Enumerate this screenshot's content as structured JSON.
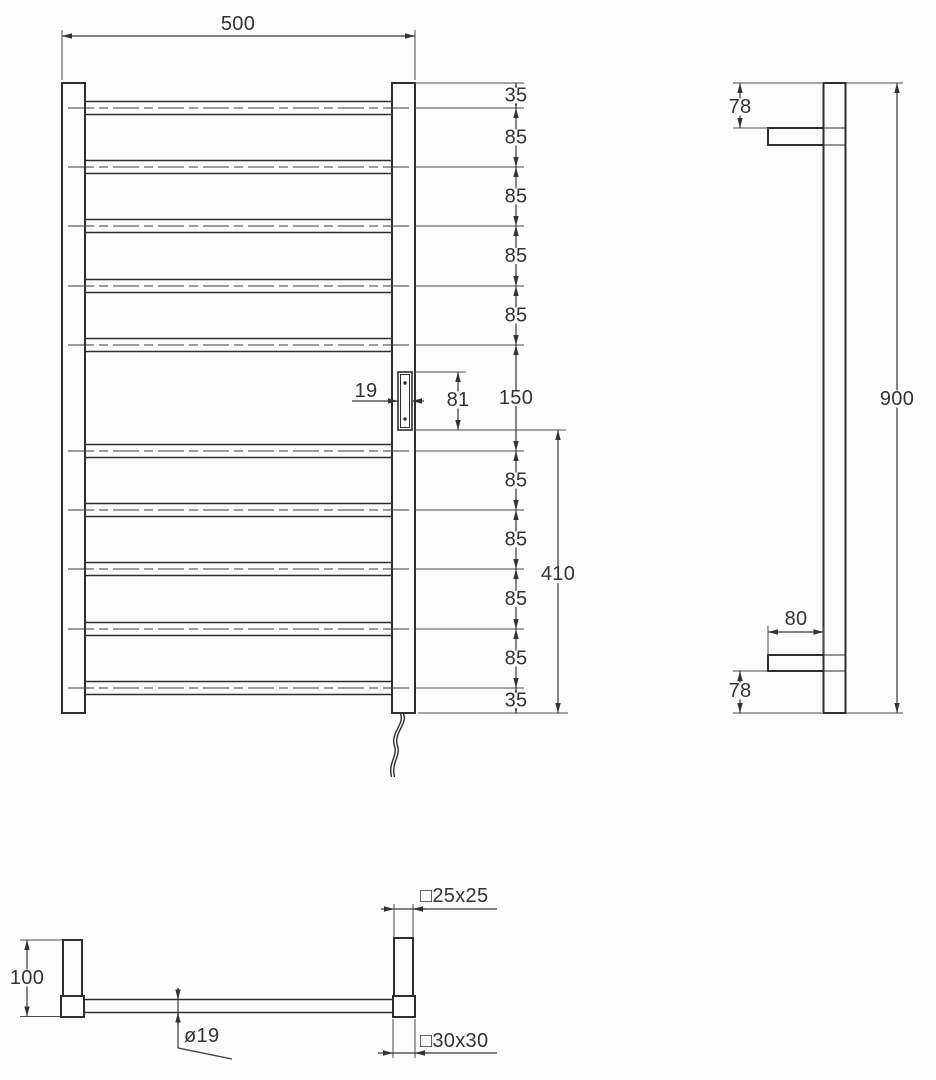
{
  "drawing": {
    "background": "#fcfcfc",
    "line_color": "#2e2e2e",
    "text_color": "#333333",
    "front_view": {
      "rung_count": 10,
      "width": "500",
      "spacing_chain": [
        "35",
        "85",
        "85",
        "85",
        "85",
        "150",
        "85",
        "85",
        "85",
        "85",
        "35"
      ],
      "lower_span": "410",
      "bracket_width": "19",
      "bracket_height": "81"
    },
    "side_view": {
      "top_offset": "78",
      "height": "900",
      "bracket_depth": "80",
      "bottom_offset": "78"
    },
    "bottom_view": {
      "post_height": "100",
      "tube_diameter": "ø19",
      "post_profile": "□25x25",
      "base_profile": "□30x30"
    }
  }
}
